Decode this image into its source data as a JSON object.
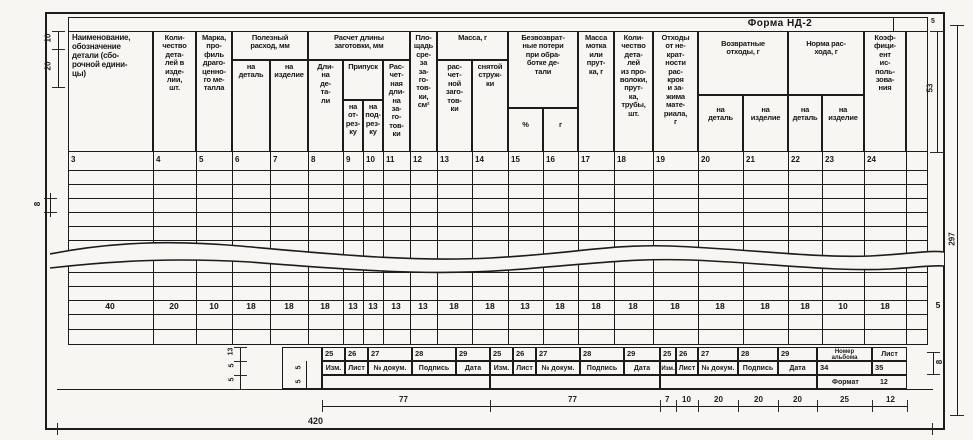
{
  "form": {
    "title": "Форма НД-2"
  },
  "header": {
    "groups": {
      "poleznyi": "Полезный\nрасход, мм",
      "raschet": "Расчет длины\nзаготовки, мм",
      "pripusk": "Припуск",
      "massa": "Масса, г",
      "poteri": "Безвозврат-\nные потери\nпри обра-\nботке де-\nтали",
      "vozvrat": "Возвратные\nотходы, г",
      "norma": "Норма рас-\nхода, г"
    },
    "cols": {
      "c3": "Наименование,\nобозначение\nдетали (сбо-\nрочной едини-\nцы)",
      "c4": "Коли-\nчество\nдета-\nлей в\nизде-\nлии,\nшт.",
      "c5": "Марка,\nпро-\nфиль\nдраго-\nценно-\nго ме-\nталла",
      "c6": "на\nдеталь",
      "c7": "на\nизделие",
      "c8": "Дли-\nна\nде-\nта-\nли",
      "c9": "на\nот-\nрез-\nку",
      "c10": "на\nпод-\nрез-\nку",
      "c11": "Рас-\nчет-\nная\nдли-\nна\nза-\nго-\nтов-\nки",
      "c12": "Пло-\nщадь\nсре-\nза\nза-\nго-\nтов-\nки,\nсм²",
      "c13": "рас-\nчет-\nной\nзаго-\nтов-\nки",
      "c14": "снятой\nструж-\nки",
      "c15": "%",
      "c16": "г",
      "c17": "Масса\nмотка\nили\nпрут-\nка, г",
      "c18": "Коли-\nчество\nдета-\nлей\nиз про-\nволоки,\nпрут-\nка,\nтрубы,\nшт.",
      "c19": "Отходы\nот не-\nкрат-\nности\nрас-\nкроя\nи за-\nжима\nмате-\nриала,\nг",
      "c20": "на\nдеталь",
      "c21": "на\nизделие",
      "c22": "на\nдеталь",
      "c23": "на\nизделие",
      "c24": "Коэф-\nфици-\nент\nис-\nполь-\nзова-\nния"
    },
    "numbers": [
      "3",
      "4",
      "5",
      "6",
      "7",
      "8",
      "9",
      "10",
      "11",
      "12",
      "13",
      "14",
      "15",
      "16",
      "17",
      "18",
      "19",
      "20",
      "21",
      "22",
      "23",
      "24"
    ]
  },
  "widths_row": [
    "40",
    "20",
    "10",
    "18",
    "18",
    "18",
    "13",
    "13",
    "13",
    "13",
    "18",
    "18",
    "13",
    "18",
    "18",
    "18",
    "18",
    "18",
    "18",
    "18",
    "10",
    "18",
    "5"
  ],
  "footer": {
    "block_numbers": [
      "25",
      "26",
      "27",
      "28",
      "29"
    ],
    "block_labels": [
      "Изм.",
      "Лист",
      "№ докум.",
      "Подпись",
      "Дата"
    ],
    "album": {
      "col1": "Номер\nальбома",
      "col2": "Лист",
      "v1": "34",
      "v2": "35",
      "format_label": "Формат",
      "format_value": "12"
    }
  },
  "dims": {
    "d10": "10",
    "d20": "20",
    "d8_row": "8",
    "d5_top": "5",
    "d53": "53",
    "d297": "297",
    "d8_footer": "8",
    "bottom": [
      "77",
      "77",
      "7",
      "10",
      "20",
      "20",
      "20",
      "25",
      "12"
    ],
    "total_w": "420",
    "footer_rows": [
      "13",
      "5",
      "5"
    ],
    "footer_rows2": [
      "5",
      "5"
    ]
  }
}
